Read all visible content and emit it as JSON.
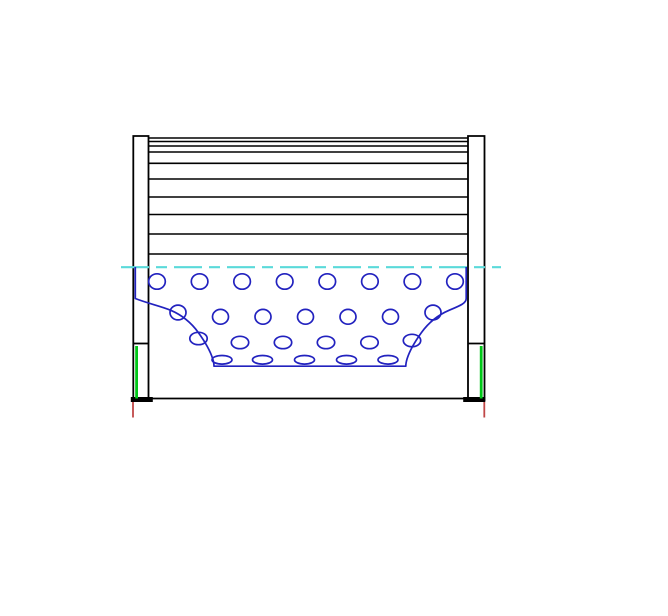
{
  "canvas": {
    "width": 668,
    "height": 616,
    "background": "#ffffff"
  },
  "colors": {
    "outline": "#000000",
    "core_blue": "#2222bf",
    "centerline_cyan": "#5adada",
    "seal_green": "#00c818",
    "datum_red": "#c04747",
    "background": "#ffffff"
  },
  "stroke_widths": {
    "outline": 1.8,
    "pleat": 1.6,
    "core": 1.7,
    "centerline": 2.2,
    "seal": 2.8,
    "datum": 1.8
  },
  "diagram": {
    "kind": "filter-cartridge-section-drawing",
    "end_caps": {
      "left": {
        "x1": 133.3,
        "x2": 148.5,
        "top": 136,
        "bottom": 401.5
      },
      "right": {
        "x1": 468.0,
        "x2": 484.5,
        "top": 136,
        "bottom": 401.5
      }
    },
    "pleat_lines": {
      "x1": 148.5,
      "x2": 468.0,
      "ys": [
        138,
        141.5,
        146,
        152,
        163.3,
        179,
        197,
        214.5,
        234,
        254
      ]
    },
    "seam_ticks": [
      {
        "x1": 133.3,
        "x2": 148.5,
        "y": 343.5
      },
      {
        "x1": 468.0,
        "x2": 484.5,
        "y": 343.5
      }
    ],
    "bottom_line": {
      "x1": 148.5,
      "x2": 468.0,
      "y": 398.5
    },
    "bottom_bars": [
      {
        "x": 130.8,
        "y": 397.0,
        "w": 22.0,
        "h": 5.0
      },
      {
        "x": 463.2,
        "y": 397.0,
        "w": 22.0,
        "h": 5.0
      }
    ],
    "seal_lines": [
      {
        "x": 136.6,
        "y1": 346,
        "y2": 398.5
      },
      {
        "x": 481.2,
        "y1": 346,
        "y2": 398.5
      }
    ],
    "datum_lines": [
      {
        "x": 133.0,
        "y1": 402,
        "y2": 417.5
      },
      {
        "x": 484.3,
        "y1": 402,
        "y2": 417.5
      }
    ],
    "centerline": {
      "x1": 121,
      "x2": 501,
      "y": 267.2,
      "dash": "28 7 11 7"
    },
    "core_outline": "M 135.3 267 L 135.3 298.5 C 148 303.5 160.5 306 170.5 310.2 C 182.5 315.3 191.8 323.5 198.3 332.5 C 204.8 341.5 210.2 350.8 212.7 358.8 C 213.6 361.8 214 363.8 214 366.2 L 405.8 366.2 C 405.8 363.8 406.2 361.8 407.1 358.8 C 409.6 350.8 415 341.5 421.5 332.5 C 428 323.5 437.3 315.3 449.3 310.2 C 459.3 306 466.2 303.5 466.2 298.5 L 466.2 267",
    "hole_rows": [
      {
        "cy": 281.5,
        "rx": 8.3,
        "ry": 7.7,
        "cxs": [
          157,
          199.6,
          242.1,
          284.7,
          327.3,
          369.9,
          412.4,
          455
        ]
      },
      {
        "cy": 316.8,
        "rx": 8.0,
        "ry": 7.4,
        "cxs": [
          220.5,
          263,
          305.5,
          348,
          390.5
        ]
      },
      {
        "cy": 342.5,
        "rx": 8.7,
        "ry": 6.2,
        "cxs": [
          240,
          283,
          326,
          369.5
        ]
      },
      {
        "cy": 359.8,
        "rx": 10.0,
        "ry": 4.3,
        "cxs": [
          222,
          262.5,
          304.5,
          346.5,
          388
        ]
      }
    ],
    "partial_holes": [
      {
        "cx": 178.0,
        "cy": 312.5,
        "rx": 8.0,
        "ry": 7.4
      },
      {
        "cx": 433.0,
        "cy": 312.5,
        "rx": 8.0,
        "ry": 7.4
      },
      {
        "cx": 198.5,
        "cy": 338.5,
        "rx": 8.7,
        "ry": 6.2
      },
      {
        "cx": 412.0,
        "cy": 340.5,
        "rx": 8.7,
        "ry": 6.2
      }
    ]
  }
}
